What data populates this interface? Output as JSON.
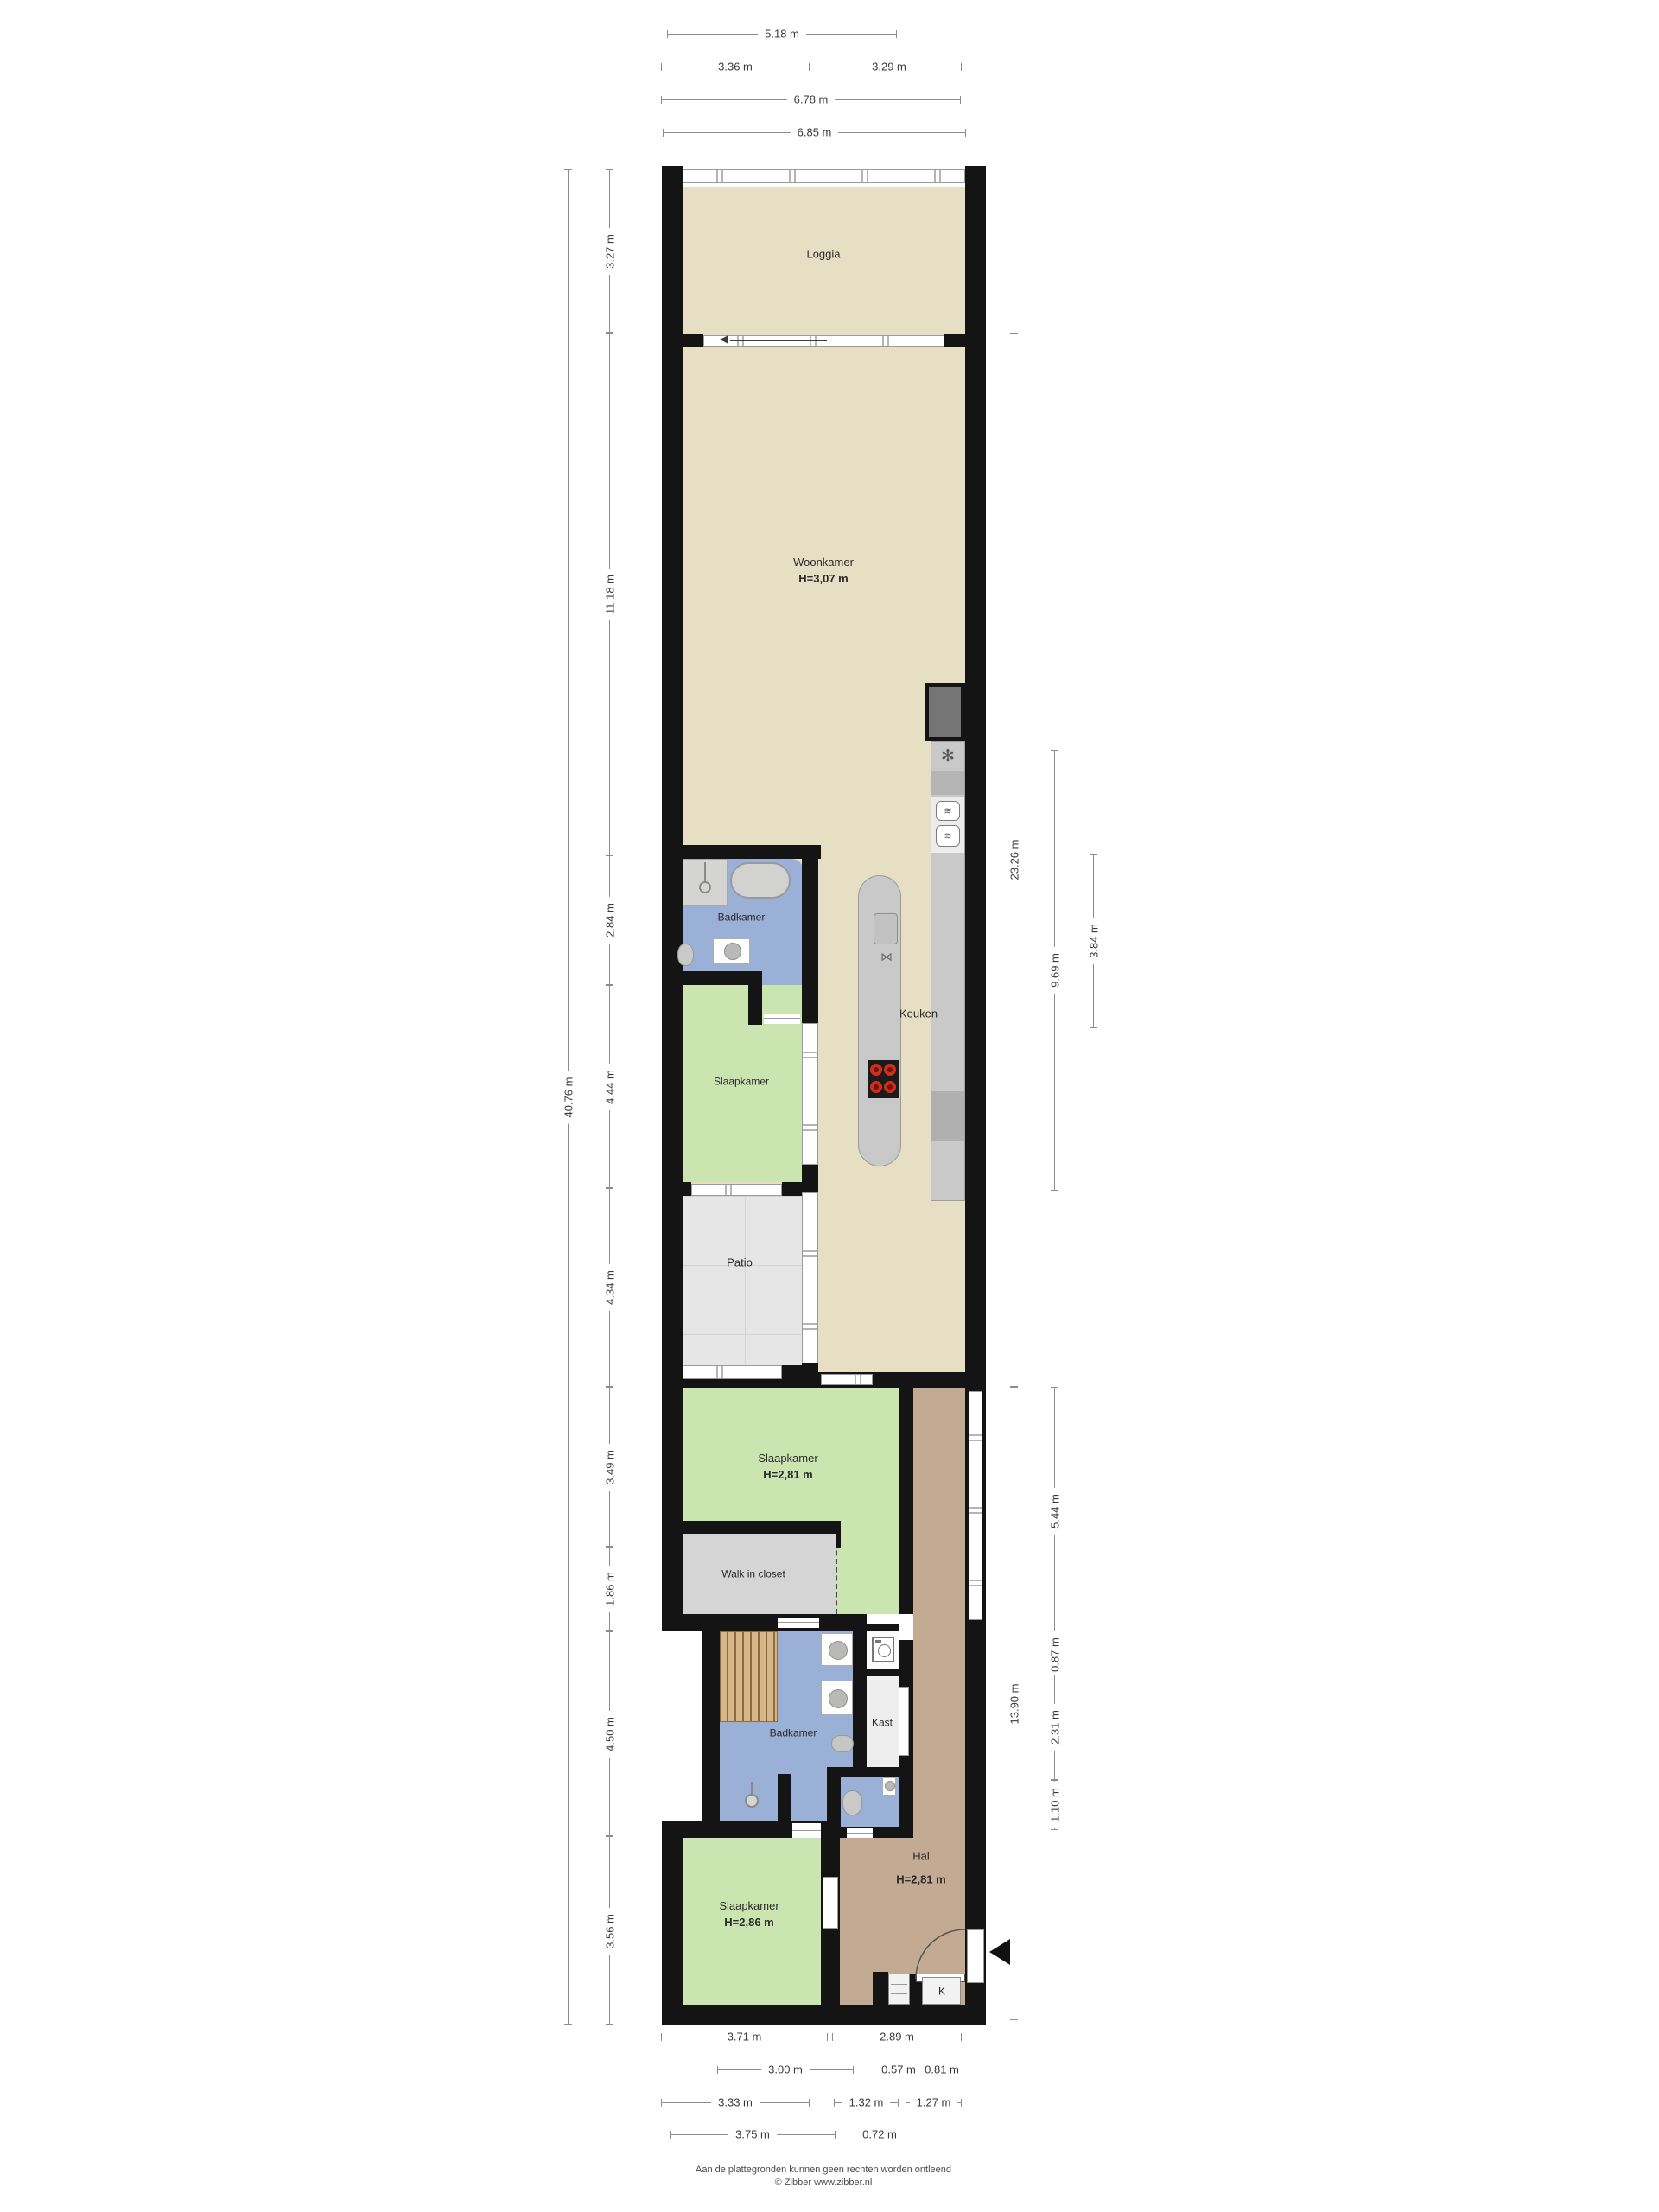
{
  "page": {
    "background": "#ffffff"
  },
  "rooms": {
    "loggia": {
      "name": "Loggia"
    },
    "woonkamer": {
      "name": "Woonkamer",
      "height": "H=3,07 m"
    },
    "badkamer_1": {
      "name": "Badkamer"
    },
    "keuken": {
      "name": "Keuken"
    },
    "slaapkamer_1": {
      "name": "Slaapkamer"
    },
    "patio": {
      "name": "Patio"
    },
    "slaapkamer_2": {
      "name": "Slaapkamer",
      "height": "H=2,81 m"
    },
    "walk_in_closet": {
      "name": "Walk in closet"
    },
    "badkamer_2": {
      "name": "Badkamer"
    },
    "kast": {
      "name": "Kast"
    },
    "hal": {
      "name": "Hal",
      "height": "H=2,81 m"
    },
    "slaapkamer_3": {
      "name": "Slaapkamer",
      "height": "H=2,86 m"
    },
    "entree_kast": {
      "name": "K"
    }
  },
  "dimensions": {
    "top": [
      "5.18 m",
      "3.36 m",
      "3.29 m",
      "6.78 m",
      "6.85 m"
    ],
    "bottom": [
      "3.71 m",
      "2.89 m",
      "3.00 m",
      "0.57 m",
      "0.81 m",
      "3.33 m",
      "1.32 m",
      "1.27 m",
      "3.75 m",
      "0.72 m"
    ],
    "left": [
      "40.76 m",
      "3.27 m",
      "11.18 m",
      "2.84 m",
      "4.44 m",
      "4.34 m",
      "3.49 m",
      "1.86 m",
      "4.50 m",
      "3.56 m"
    ],
    "right": [
      "23.26 m",
      "9.69 m",
      "3.84 m",
      "13.90 m",
      "5.44 m",
      "0.87 m",
      "2.31 m",
      "1.10 m"
    ]
  },
  "icons": {
    "freezer": "✻",
    "oven": "≋",
    "faucet": "⋈"
  },
  "colors": {
    "wall": "#141414",
    "living_floor": "#e7dfc4",
    "bath_floor": "#9ab0d6",
    "bedroom_floor": "#cbe5b1",
    "patio_floor": "#e6e6e6",
    "hal_floor": "#c2aa93",
    "closet_floor": "#d5d5d5",
    "kast_floor": "#eeeeee",
    "counter": "#c9c9c9",
    "wood": "#d7b688",
    "burner": "#cf2e1a"
  },
  "footer": {
    "disclaimer": "Aan de plattegronden kunnen geen rechten worden ontleend",
    "copyright": "© Zibber www.zibber.nl"
  }
}
